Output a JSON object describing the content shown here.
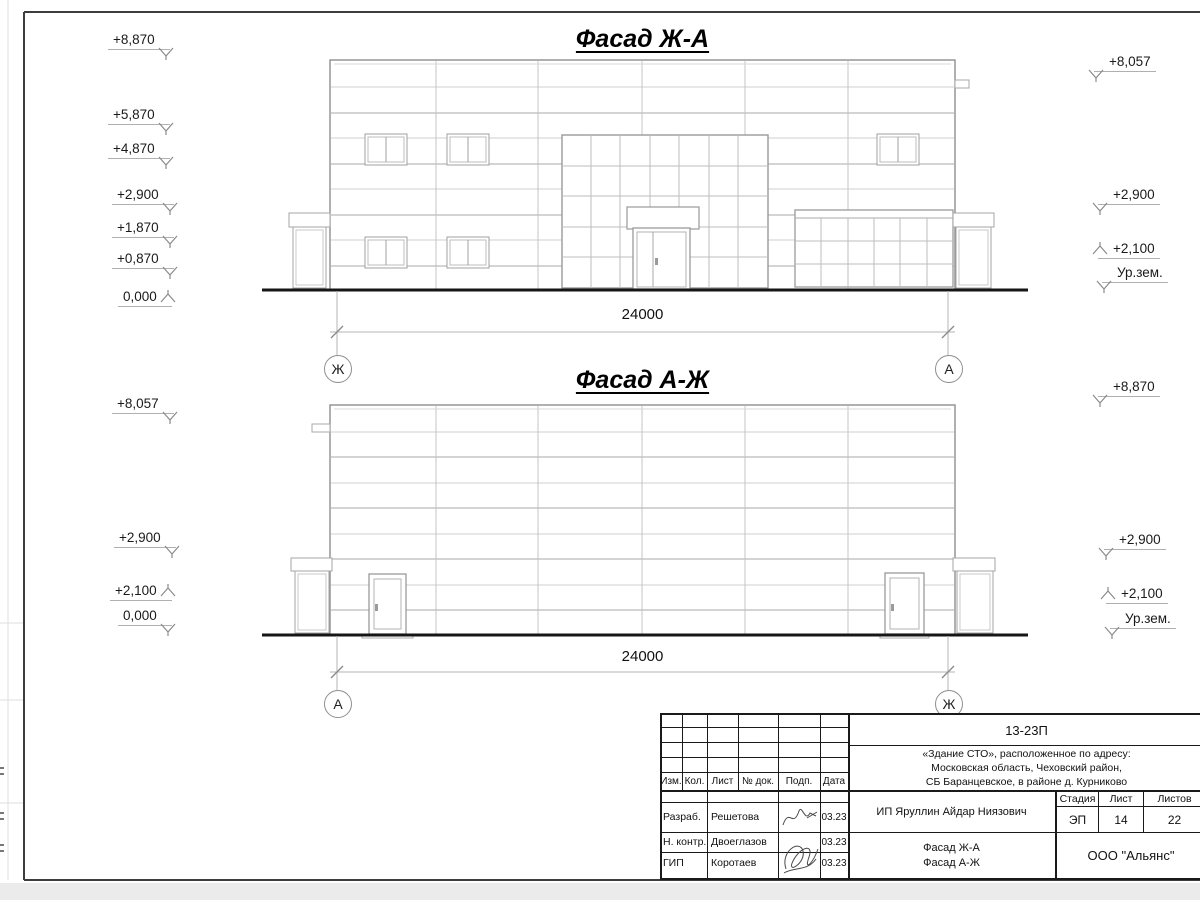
{
  "facade1": {
    "title": "Фасад Ж-А",
    "dim": "24000",
    "axis_left": "Ж",
    "axis_right": "А",
    "marks_left": [
      "+8,870",
      "+5,870",
      "+4,870",
      "+2,900",
      "+1,870",
      "+0,870",
      "0,000"
    ],
    "marks_right": [
      "+8,057",
      "+2,900",
      "+2,100",
      "Ур.зем."
    ]
  },
  "facade2": {
    "title": "Фасад А-Ж",
    "dim": "24000",
    "axis_left": "А",
    "axis_right": "Ж",
    "marks_left": [
      "+8,057",
      "+2,900",
      "+2,100",
      "0,000"
    ],
    "marks_right": [
      "+8,870",
      "+2,900",
      "+2,100",
      "Ур.зем."
    ]
  },
  "stamp": {
    "code": "13-23П",
    "project_line1": "«Здание СТО», расположенное по адресу:",
    "project_line2": "Московская область, Чеховский район,",
    "project_line3": "СБ Баранцевское, в районе д. Курниково",
    "client": "ИП Яруллин Айдар Ниязович",
    "drawing_line1": "Фасад Ж-А",
    "drawing_line2": "Фасад А-Ж",
    "organization": "ООО \"Альянс\"",
    "columns": [
      "Изм.",
      "Кол.",
      "Лист",
      "№ док.",
      "Подп.",
      "Дата"
    ],
    "stage_label": "Стадия",
    "sheet_label": "Лист",
    "sheets_label": "Листов",
    "stage": "ЭП",
    "sheet": "14",
    "sheets": "22",
    "rows": [
      {
        "role": "Разраб.",
        "name": "Решетова",
        "date": "03.23"
      },
      {
        "role": "Н. контр.",
        "name": "Двоеглазов",
        "date": "03.23"
      },
      {
        "role": "ГИП",
        "name": "Коротаев",
        "date": "03.23"
      }
    ]
  }
}
